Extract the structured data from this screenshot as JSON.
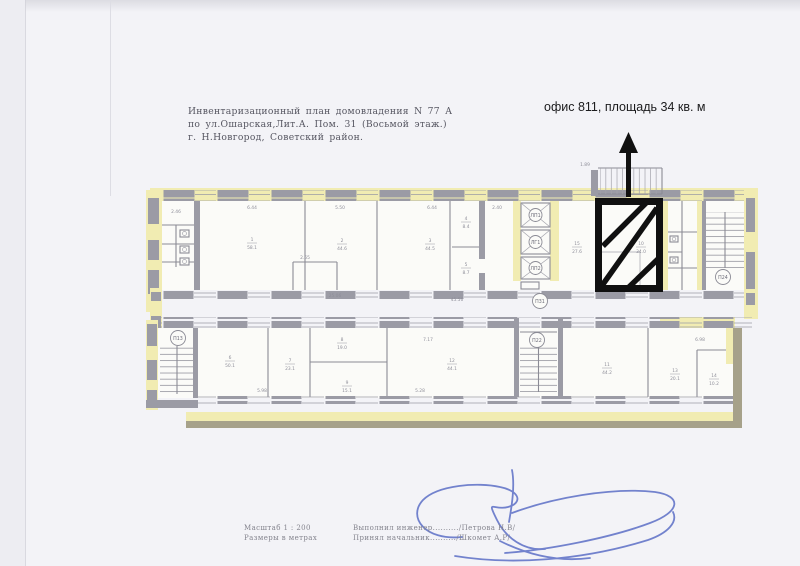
{
  "page": {
    "title_lines": [
      "Инвентаризационный план домовладения N 77 А",
      "по ул.Ошарская,Лит.А. Пом. 31 (Восьмой этаж.)",
      "г. Н.Новгород, Советский район."
    ],
    "annotation": "офис 811, площадь 34 кв. м",
    "footer": {
      "scale": "Масштаб 1 : 200",
      "units": "Размеры в метрах",
      "executed": "Выполнил инженер........../Петрова Н.В/",
      "accepted": "Принял начальник........../Шкомет А.Р/"
    }
  },
  "plan": {
    "stair_labels": {
      "bottom_left": "П13",
      "bottom_middle": "П22",
      "corridor": "П31",
      "top_right": "П24"
    },
    "elevator_labels": [
      "ЛП1",
      "ЛГ1",
      "ЛП2"
    ],
    "room_labels": [
      {
        "num": "1",
        "area": "58.1",
        "x": 252,
        "y": 243
      },
      {
        "num": "2",
        "area": "44.6",
        "x": 342,
        "y": 244
      },
      {
        "num": "3",
        "area": "44.5",
        "x": 430,
        "y": 244
      },
      {
        "num": "4",
        "area": "8.4",
        "x": 466,
        "y": 222
      },
      {
        "num": "5",
        "area": "8.7",
        "x": 466,
        "y": 268
      },
      {
        "num": "15",
        "area": "27.6",
        "x": 577,
        "y": 247
      },
      {
        "num": "10",
        "area": "34.0",
        "x": 641,
        "y": 247
      },
      {
        "num": "6",
        "area": "50.1",
        "x": 230,
        "y": 361
      },
      {
        "num": "7",
        "area": "23.1",
        "x": 290,
        "y": 364
      },
      {
        "num": "8",
        "area": "19.0",
        "x": 342,
        "y": 343
      },
      {
        "num": "9",
        "area": "15.1",
        "x": 347,
        "y": 386
      },
      {
        "num": "12",
        "area": "44.1",
        "x": 452,
        "y": 364
      },
      {
        "num": "11",
        "area": "44.2",
        "x": 607,
        "y": 368
      },
      {
        "num": "13",
        "area": "20.1",
        "x": 675,
        "y": 374
      },
      {
        "num": "14",
        "area": "10.2",
        "x": 714,
        "y": 379
      }
    ],
    "dim_labels": [
      {
        "text": "6.44",
        "x": 252,
        "y": 209
      },
      {
        "text": "5.50",
        "x": 340,
        "y": 209
      },
      {
        "text": "6.44",
        "x": 432,
        "y": 209
      },
      {
        "text": "2.40",
        "x": 497,
        "y": 209
      },
      {
        "text": "2.65",
        "x": 305,
        "y": 259
      },
      {
        "text": "2.46",
        "x": 176,
        "y": 213
      },
      {
        "text": "1.89",
        "x": 585,
        "y": 166
      },
      {
        "text": "25.06",
        "x": 335,
        "y": 297
      },
      {
        "text": "45.56",
        "x": 457,
        "y": 301
      },
      {
        "text": "7.17",
        "x": 428,
        "y": 341
      },
      {
        "text": "6.98",
        "x": 700,
        "y": 341
      },
      {
        "text": "5.98",
        "x": 262,
        "y": 392
      },
      {
        "text": "5.28",
        "x": 420,
        "y": 392
      }
    ],
    "colors": {
      "wall": "#9b9ba5",
      "highlight": "#f1ecb2",
      "olive": "#a6a18a",
      "unit_outline": "#101010",
      "ink": "#4f63c2"
    }
  }
}
